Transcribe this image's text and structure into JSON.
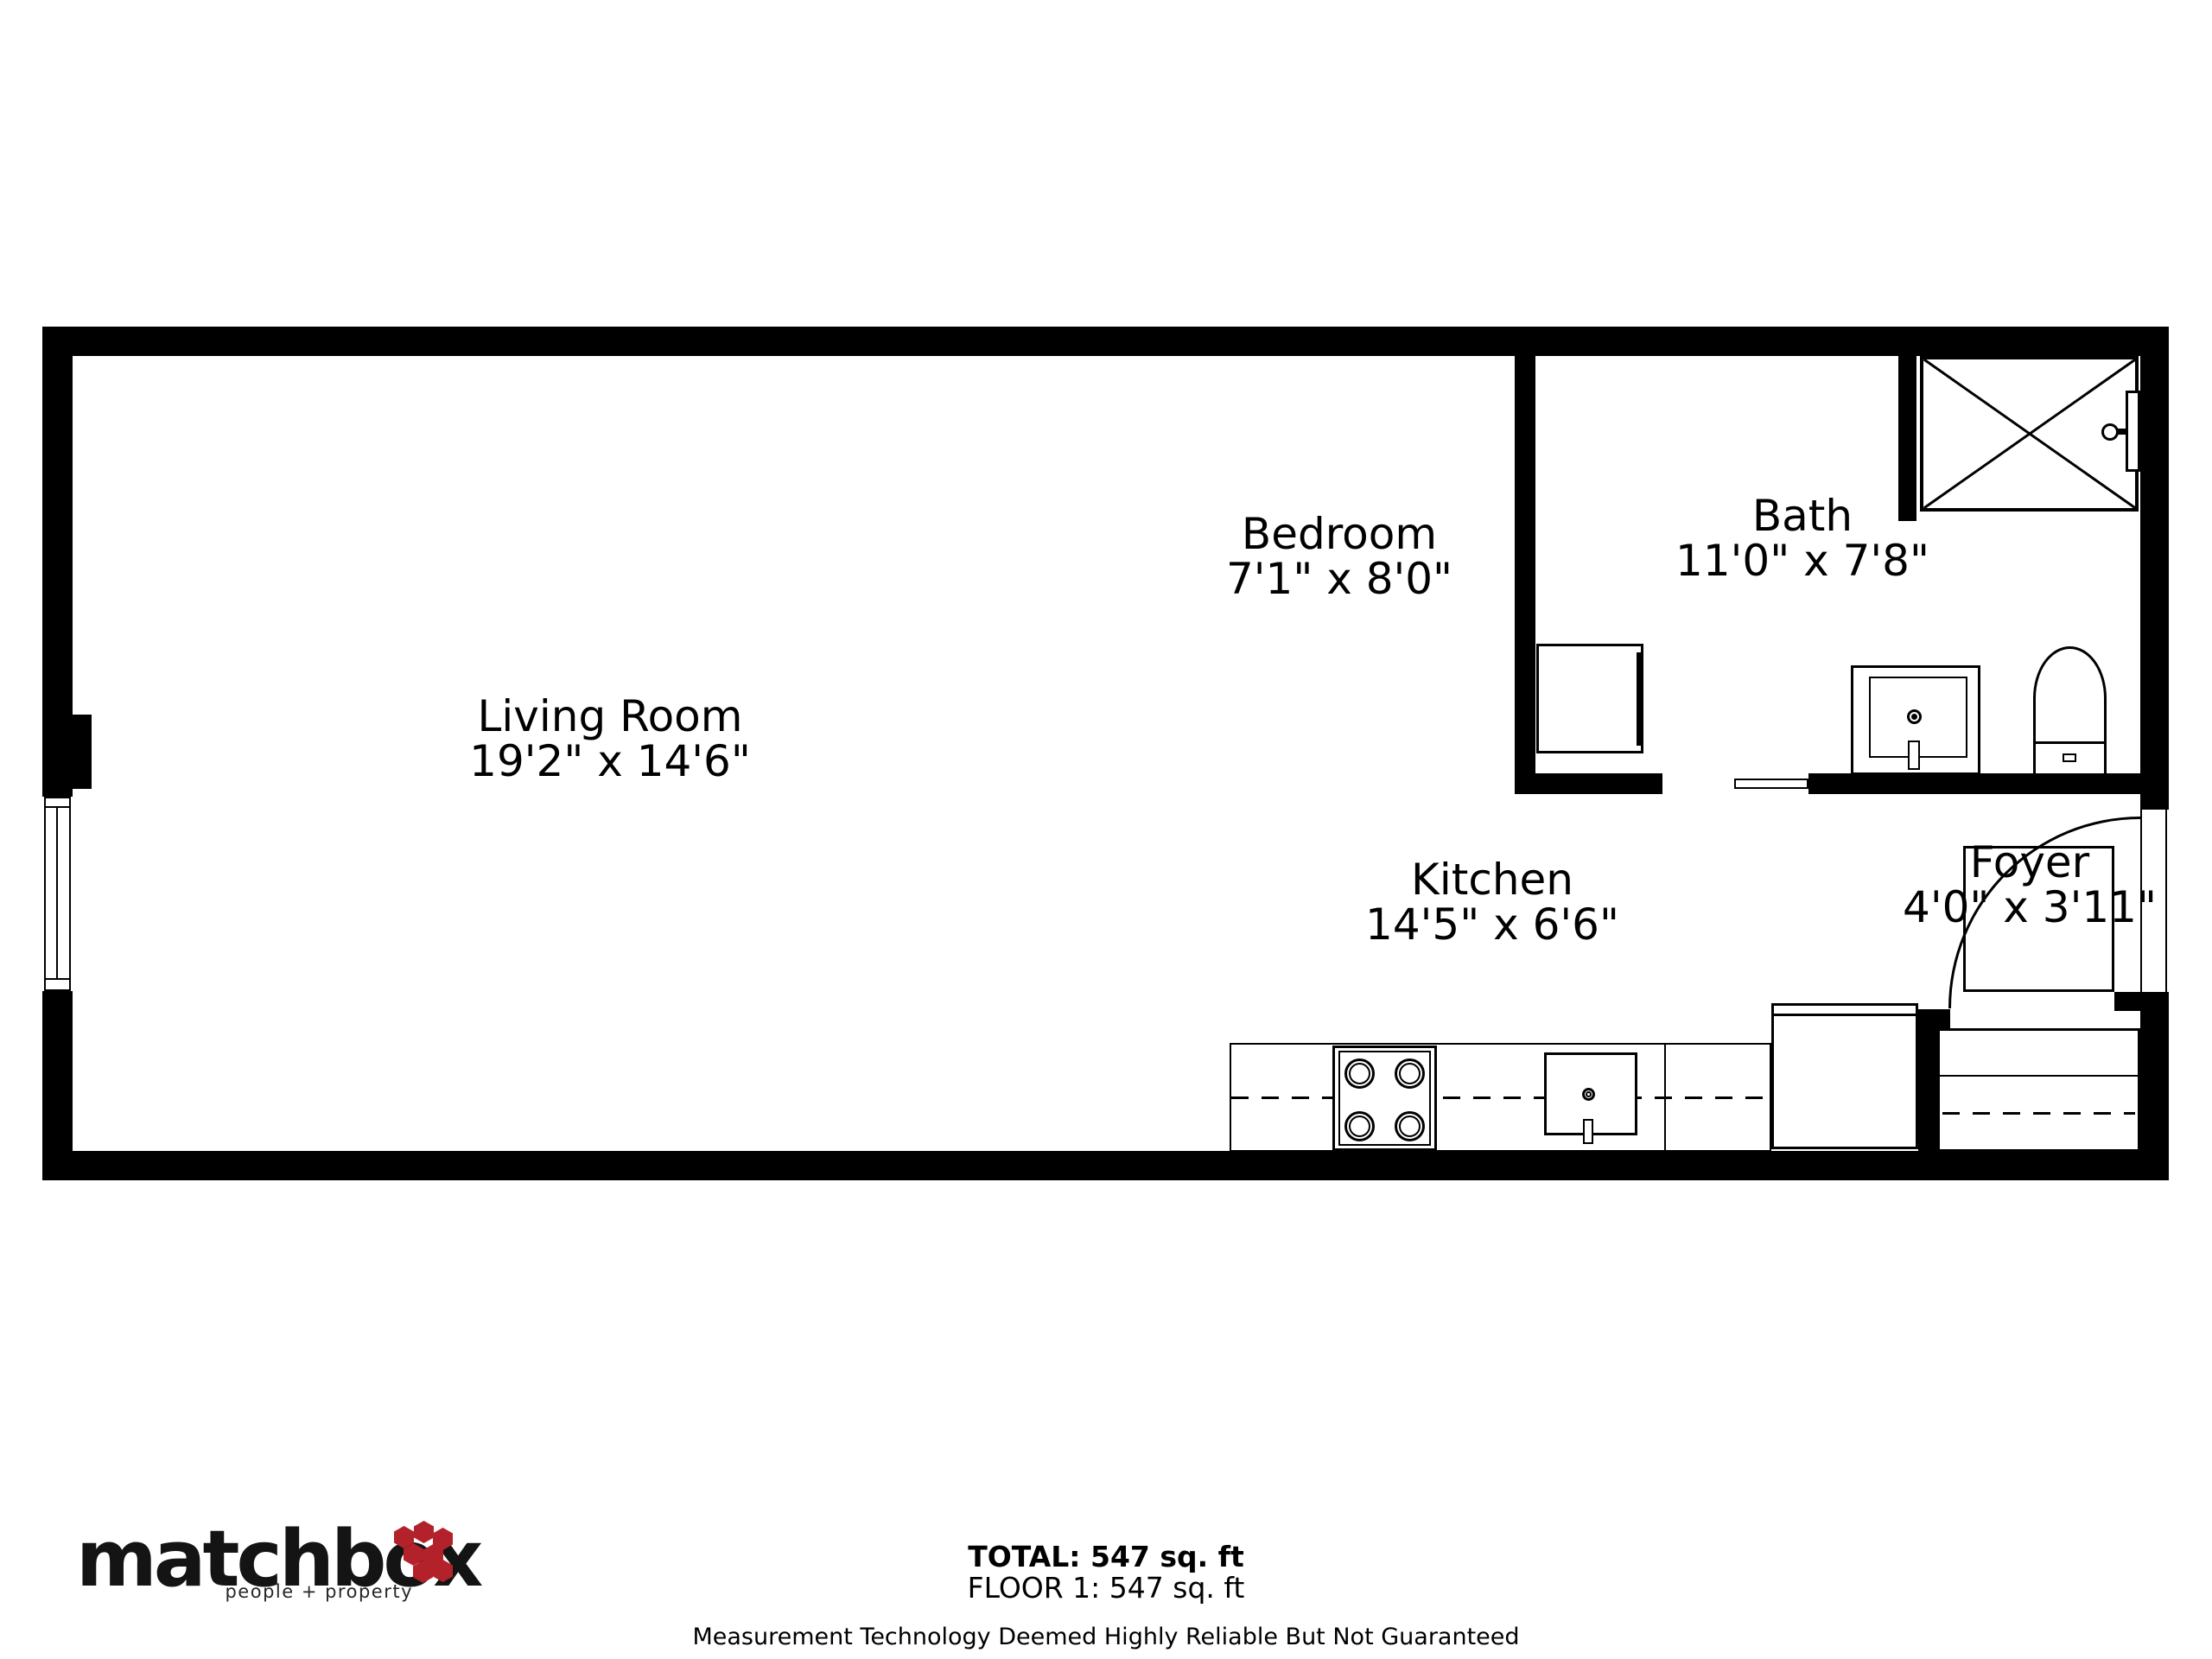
{
  "rooms": [
    {
      "id": "living-room",
      "name": "Living Room",
      "dims": "19'2\" x 14'6\""
    },
    {
      "id": "bedroom",
      "name": "Bedroom",
      "dims": "7'1\" x 8'0\""
    },
    {
      "id": "bath",
      "name": "Bath",
      "dims": "11'0\" x 7'8\""
    },
    {
      "id": "kitchen",
      "name": "Kitchen",
      "dims": "14'5\" x 6'6\""
    },
    {
      "id": "foyer",
      "name": "Foyer",
      "dims": "4'0\" x 3'11\""
    }
  ],
  "footer": {
    "total": "TOTAL: 547 sq. ft",
    "floor": "FLOOR 1: 547 sq. ft",
    "disclaimer": "Measurement Technology Deemed Highly Reliable But Not Guaranteed"
  },
  "logo": {
    "brand": "matchbox",
    "tagline": "people + property",
    "hex_color": "#b3222b"
  },
  "colors": {
    "wall": "#000000",
    "background": "#ffffff"
  }
}
